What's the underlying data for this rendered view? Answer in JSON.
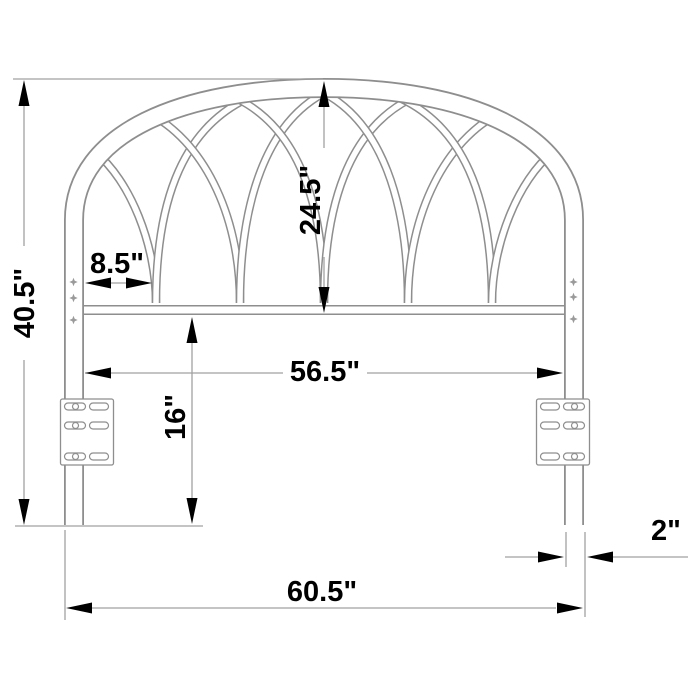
{
  "diagram": {
    "labels": {
      "overall_height": "40.5\"",
      "arch_height": "24.5\"",
      "arch_spacing": "8.5\"",
      "inner_width": "56.5\"",
      "bracket_to_floor": "16\"",
      "leg_width": "2\"",
      "overall_width": "60.5\""
    },
    "colors": {
      "background": "#ffffff",
      "drawing_line": "#8e8e8e",
      "dimension_line": "#a1a1a1",
      "annotation": "#000000"
    }
  }
}
